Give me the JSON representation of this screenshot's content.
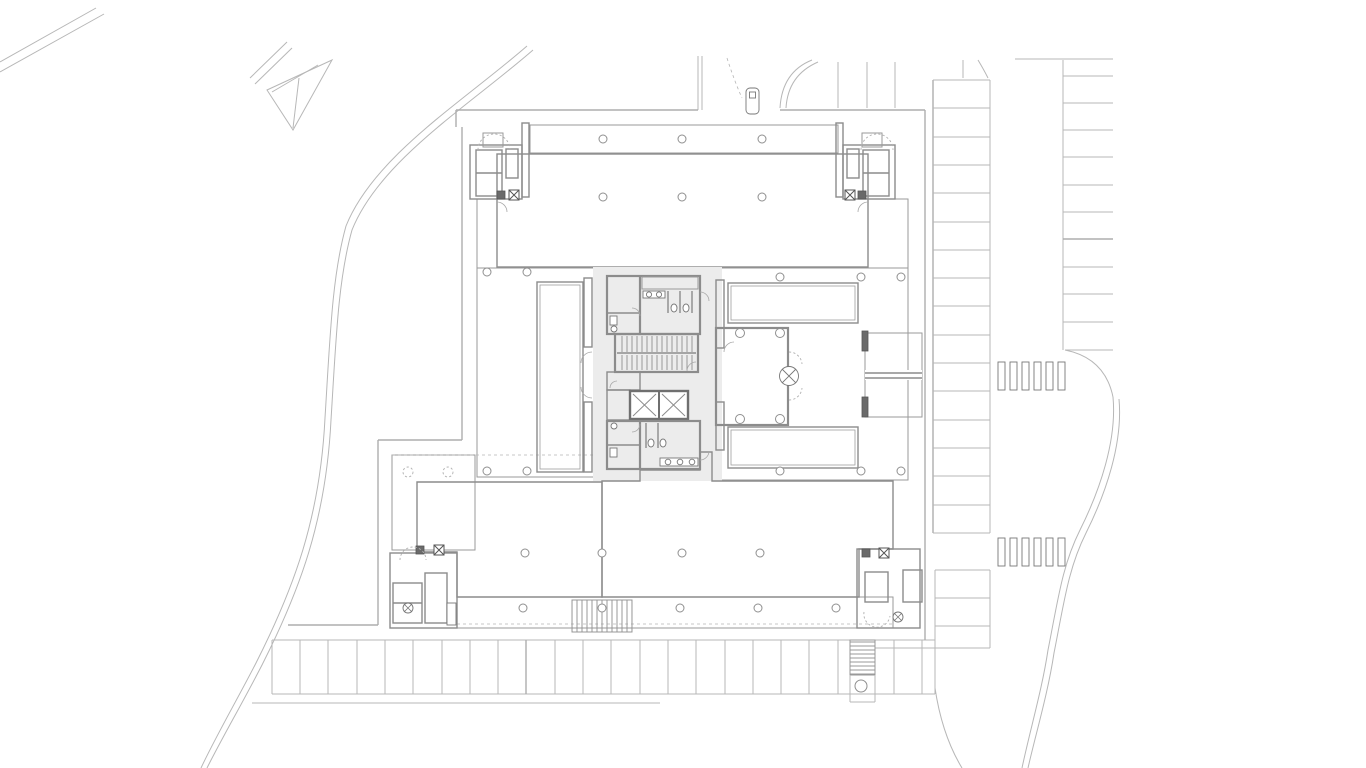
{
  "colors": {
    "background": "#ffffff",
    "floor_plate_fill": "#e8e8e8",
    "core_fill": "#ececec",
    "highlight_fill": "#a9e3d2",
    "hatch_line": "#d4d4d4",
    "wall_line": "#8c8c8c",
    "site_line": "#b7b7b7",
    "detail_line": "#9f9f9f",
    "fixture_dark": "#5a5a5a"
  },
  "plan": {
    "description": "Building site / floor plan; south-east ground-floor space highlighted in teal",
    "highlighted_space_fill": "#a9e3d2",
    "parking": {
      "east_column_stalls": 16,
      "far_east_column_stalls": 11,
      "south_row_stalls": 23,
      "north_east_stalls": 3,
      "south_east_stalls": 3
    },
    "crosswalks": [
      {
        "location": "east-upper",
        "bars": 6
      },
      {
        "location": "east-lower",
        "bars": 6
      }
    ],
    "cars_visible": 1
  }
}
